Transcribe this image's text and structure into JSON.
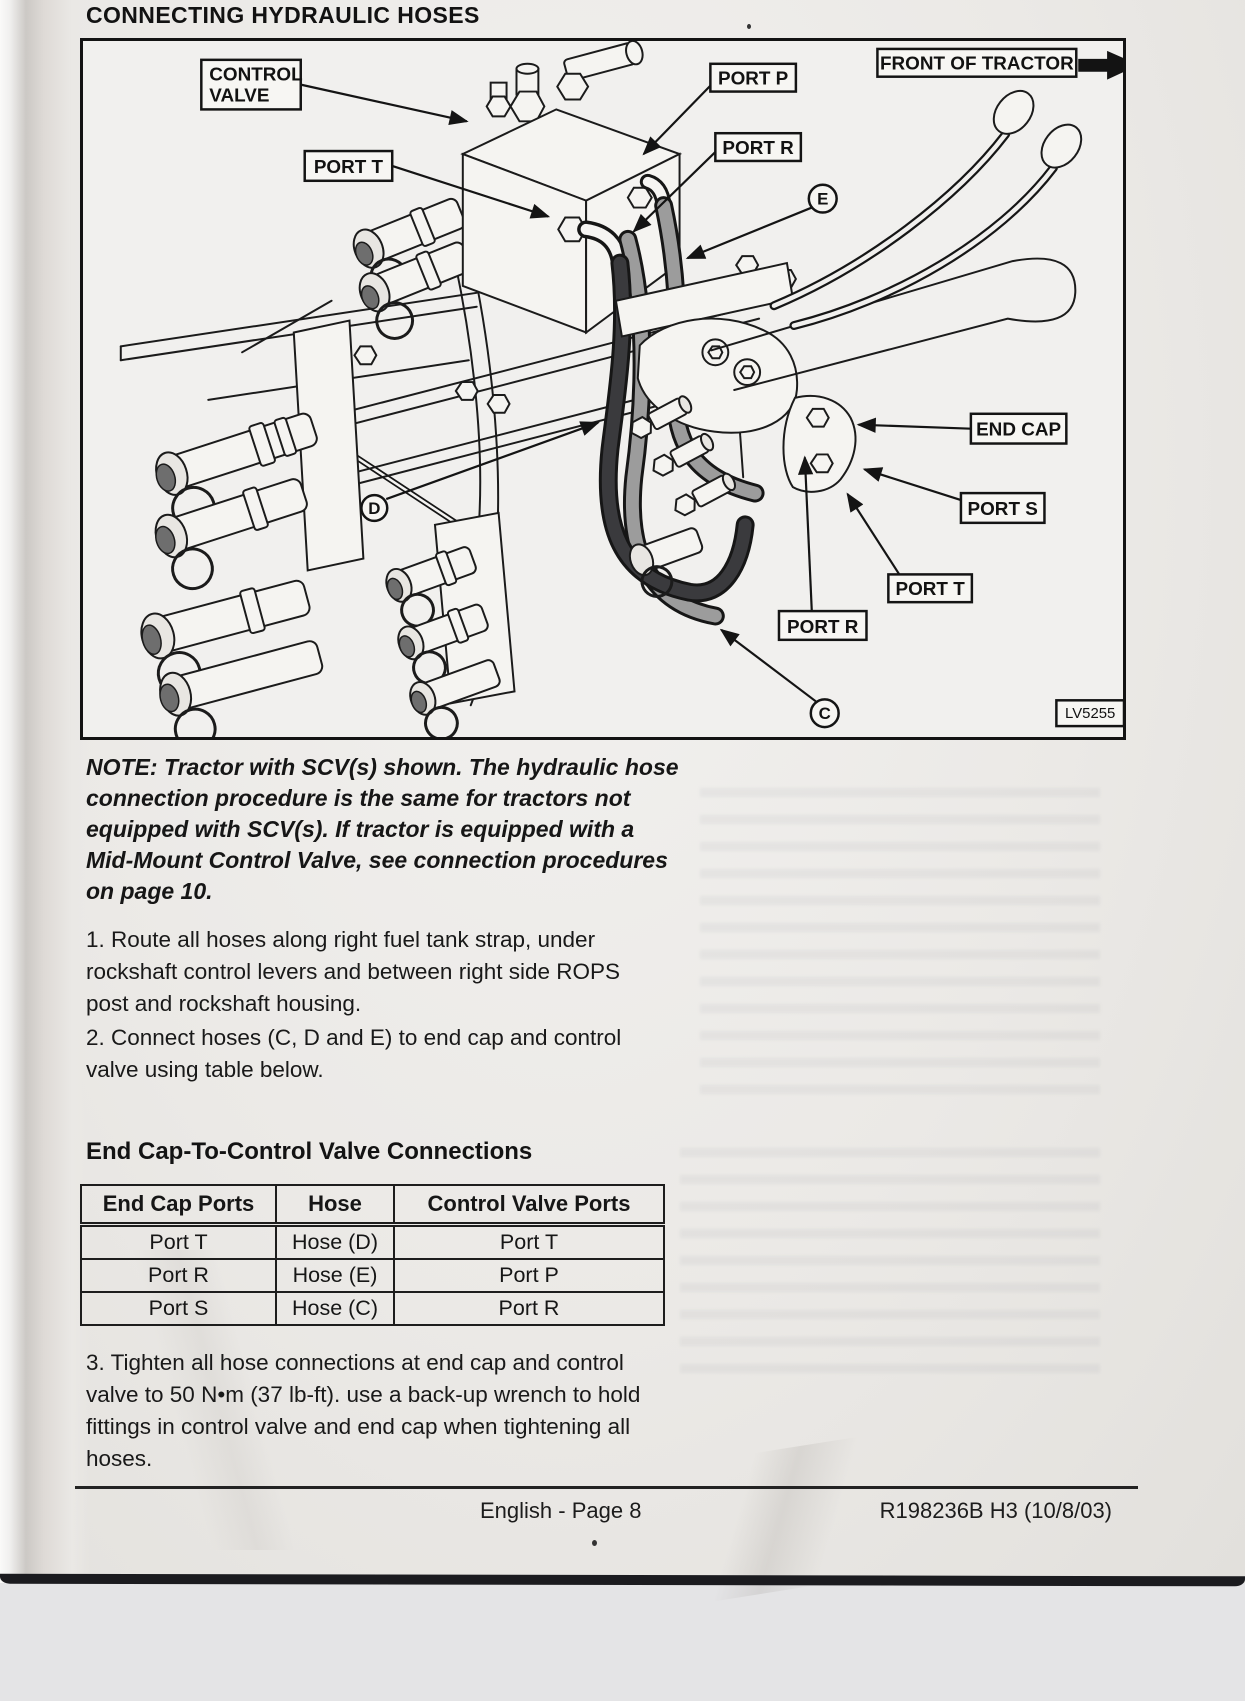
{
  "page_title": "CONNECTING HYDRAULIC HOSES",
  "figure": {
    "code": "LV5255",
    "labels": {
      "control_valve_1": "CONTROL",
      "control_valve_2": "VALVE",
      "port_t_valve": "PORT T",
      "port_p": "PORT P",
      "port_r_top": "PORT R",
      "front_of_tractor": "FRONT OF TRACTOR",
      "end_cap": "END CAP",
      "port_s": "PORT S",
      "port_t_endcap": "PORT T",
      "port_r_endcap": "PORT R",
      "callout_c": "C",
      "callout_d": "D",
      "callout_e": "E"
    }
  },
  "note_lines": [
    "NOTE: Tractor with SCV(s) shown. The hydraulic hose",
    "connection procedure is the same for tractors not",
    "equipped with SCV(s). If tractor is equipped with a",
    "Mid-Mount Control Valve, see connection procedures",
    "on page 10."
  ],
  "step1_lines": [
    "1. Route all hoses along right fuel tank strap, under",
    "rockshaft control levers and between right side ROPS",
    "post and rockshaft housing."
  ],
  "step2_lines": [
    "2. Connect hoses (C, D and E) to end cap and control",
    "valve using table below."
  ],
  "step3_lines": [
    "3. Tighten all hose connections at end cap and control",
    "valve to 50 N•m (37 lb-ft). use a back-up wrench to hold",
    "fittings in control valve and end cap when tightening all",
    "hoses."
  ],
  "table": {
    "title": "End Cap-To-Control Valve Connections",
    "headers": [
      "End Cap Ports",
      "Hose",
      "Control Valve Ports"
    ],
    "rows": [
      [
        "Port T",
        "Hose (D)",
        "Port T"
      ],
      [
        "Port R",
        "Hose (E)",
        "Port P"
      ],
      [
        "Port S",
        "Hose (C)",
        "Port R"
      ]
    ]
  },
  "footer": {
    "center": "English - Page 8",
    "right": "R198236B H3 (10/8/03)"
  }
}
